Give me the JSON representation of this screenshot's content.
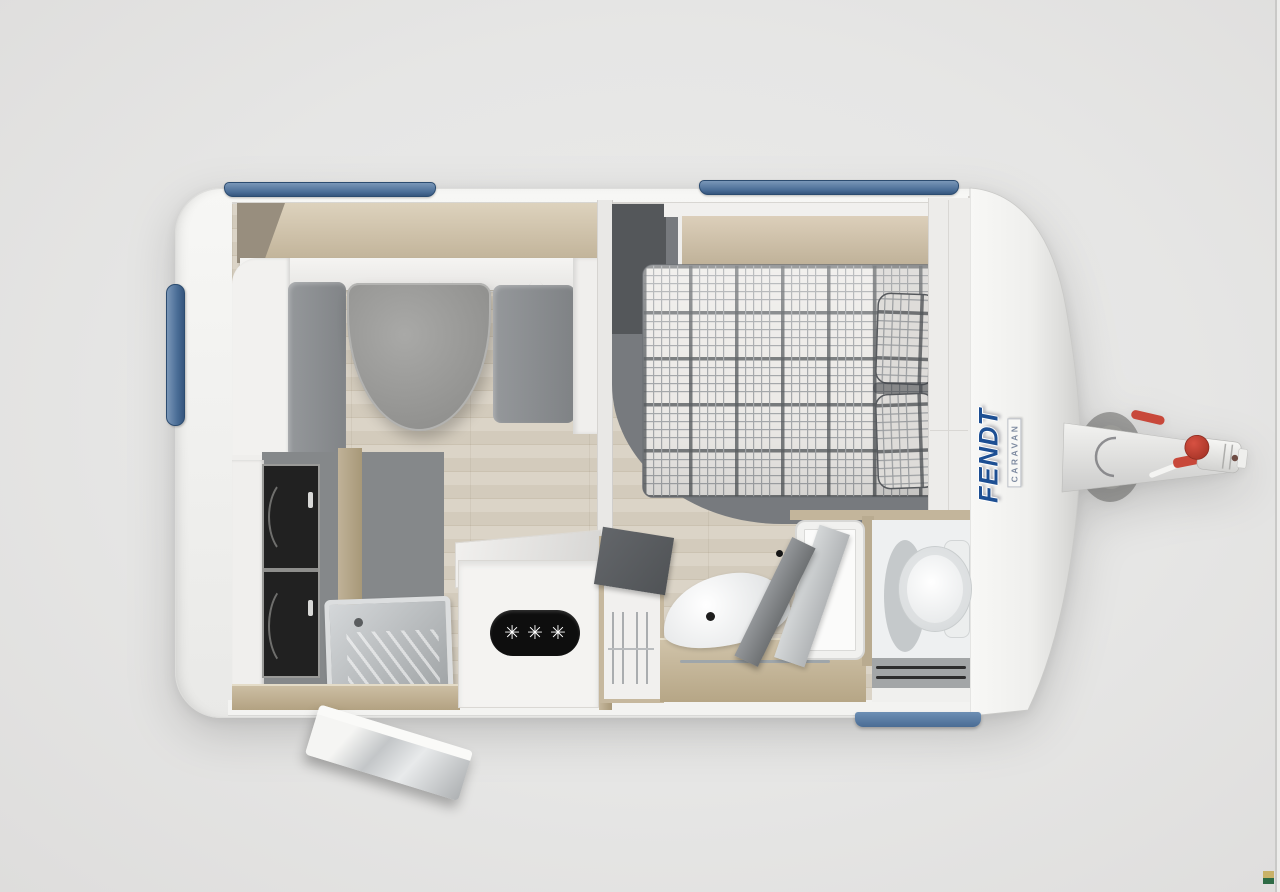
{
  "image": {
    "background_color": "#e6e6e5",
    "type_note": "top-down 3D rendered caravan floor plan product photo"
  },
  "caravan": {
    "brand": {
      "name": "FENDT",
      "subtitle": "CARAVAN",
      "logo_color": "#1d4f93"
    },
    "stove": {
      "burner_symbols": "✳✳✳"
    },
    "accent_colors": {
      "window_blue": "#4a6d96",
      "entry_step_blue": "#4a6c94",
      "hitch_red": "#c8483a",
      "body_white": "#f5f5f3",
      "floor_wood": "#d6cec0",
      "upholstery_gray": "#8a8d90"
    }
  },
  "watermark": {
    "top_color": "#c9b268",
    "bottom_color": "#2e6b45"
  }
}
